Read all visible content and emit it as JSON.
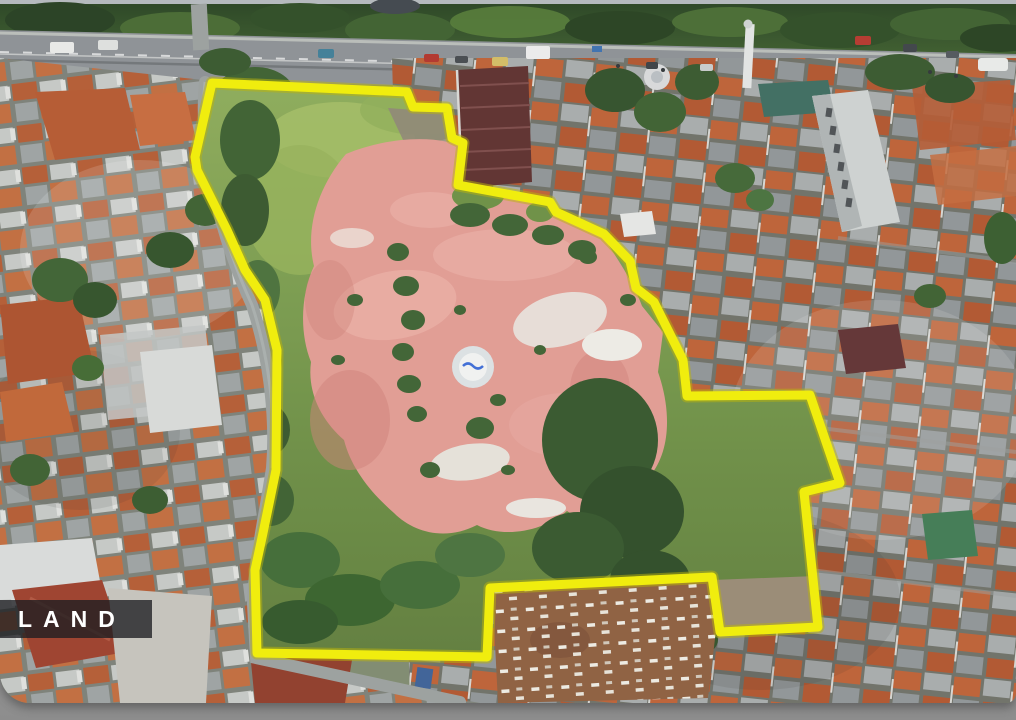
{
  "label": {
    "text": "LAND"
  },
  "boundary": {
    "color": "#F2EF04",
    "points": [
      [
        212,
        83
      ],
      [
        407,
        92
      ],
      [
        413,
        107
      ],
      [
        447,
        108
      ],
      [
        452,
        138
      ],
      [
        463,
        143
      ],
      [
        458,
        185
      ],
      [
        550,
        202
      ],
      [
        556,
        212
      ],
      [
        604,
        234
      ],
      [
        630,
        261
      ],
      [
        636,
        288
      ],
      [
        654,
        302
      ],
      [
        683,
        360
      ],
      [
        687,
        396
      ],
      [
        810,
        395
      ],
      [
        840,
        483
      ],
      [
        804,
        492
      ],
      [
        818,
        627
      ],
      [
        720,
        632
      ],
      [
        712,
        577
      ],
      [
        490,
        588
      ],
      [
        487,
        657
      ],
      [
        257,
        653
      ],
      [
        255,
        570
      ],
      [
        263,
        533
      ],
      [
        276,
        470
      ],
      [
        277,
        350
      ],
      [
        265,
        300
      ],
      [
        245,
        270
      ],
      [
        227,
        230
      ],
      [
        197,
        170
      ],
      [
        195,
        157
      ]
    ]
  },
  "palette": {
    "outline_yellow": "#F2EF04",
    "clearing_pink": "#E29B92",
    "vegetation_green": "#7FA14F",
    "tree_canopy": "#2F4C26",
    "road_gray": "#8C9094",
    "label_bg": "rgba(28,30,33,0.78)",
    "label_text": "#FFFFFF",
    "frame_gray": "#A8A8A8"
  }
}
